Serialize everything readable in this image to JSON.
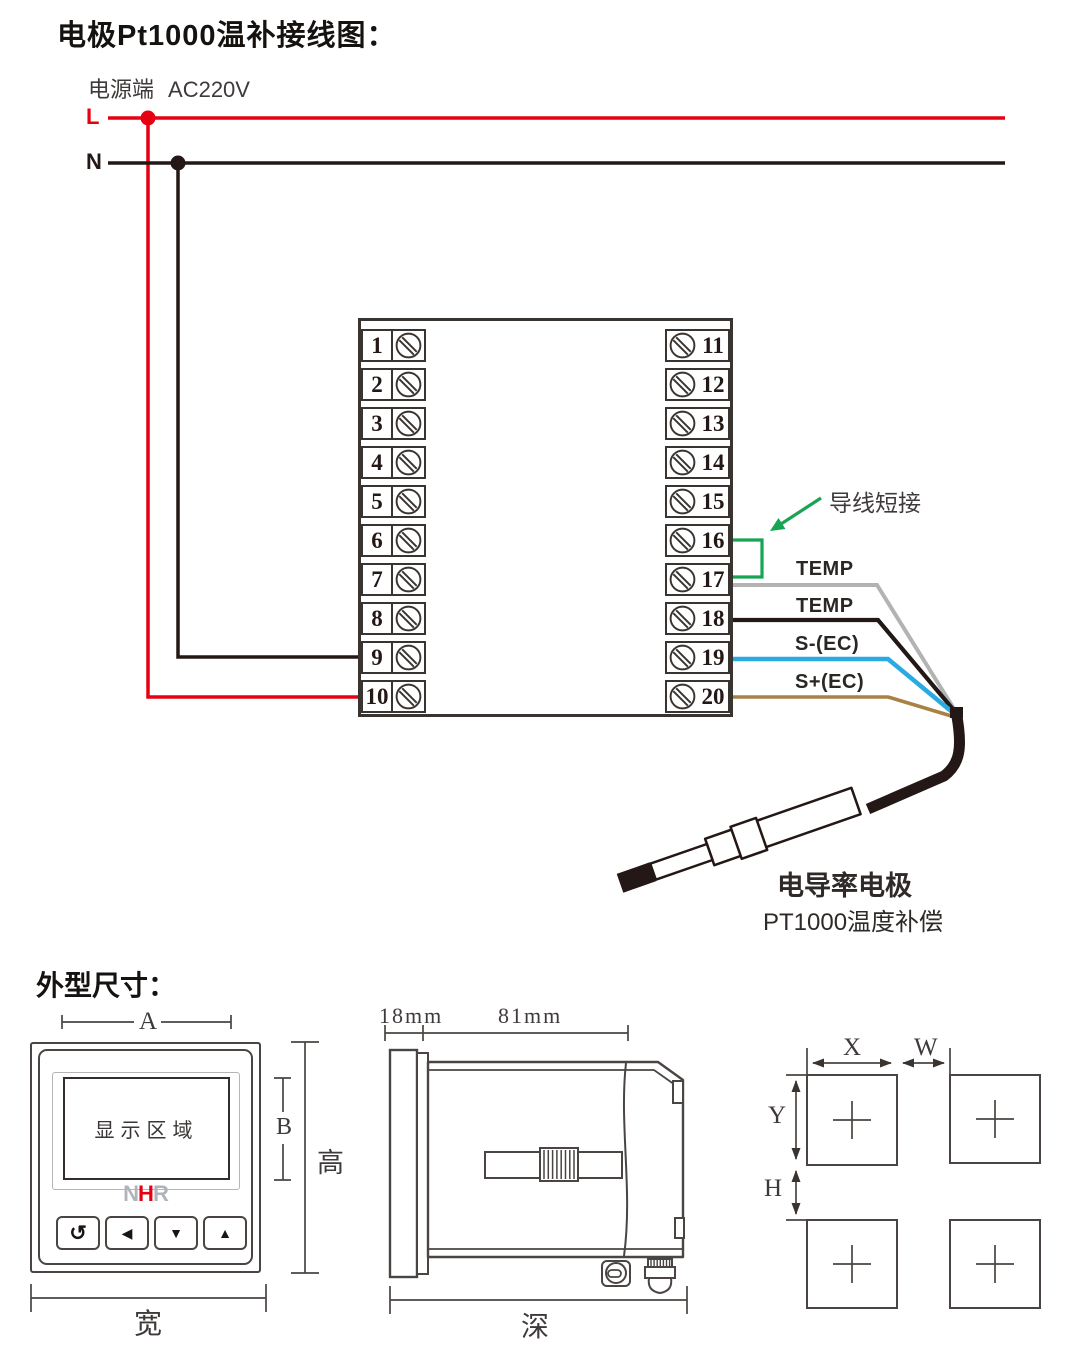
{
  "colors": {
    "red": "#e60012",
    "dark": "#231815",
    "outline": "#3a3430",
    "drawing": "#4a4542",
    "light_gray": "#b5b5b5",
    "green": "#17a554",
    "logo_gray": "#b0b4b9",
    "logo_red": "#e60012"
  },
  "wiring": {
    "title": "电极Pt1000温补接线图：",
    "power": {
      "label": "电源端",
      "voltage": "AC220V"
    },
    "live_label": "L",
    "neutral_label": "N",
    "terminals_left": [
      "1",
      "2",
      "3",
      "4",
      "5",
      "6",
      "7",
      "8",
      "9",
      "10"
    ],
    "terminals_right": [
      "11",
      "12",
      "13",
      "14",
      "15",
      "16",
      "17",
      "18",
      "19",
      "20"
    ],
    "jumper_label": "导线短接",
    "wires": [
      {
        "label": "TEMP",
        "color": "#b3b3b3"
      },
      {
        "label": "TEMP",
        "color": "#231815"
      },
      {
        "label": "S-(EC)",
        "color": "#29abe2"
      },
      {
        "label": "S+(EC)",
        "color": "#aa8145"
      }
    ],
    "probe": {
      "name": "电导率电极",
      "subtitle": "PT1000温度补偿"
    }
  },
  "outline": {
    "title": "外型尺寸：",
    "front": {
      "display_label": "显示区域",
      "logo": {
        "n": "N",
        "h": "H",
        "r": "R"
      },
      "buttons": [
        {
          "name": "loop-button",
          "glyph": "↺"
        },
        {
          "name": "left-button",
          "glyph": "◀"
        },
        {
          "name": "down-button",
          "glyph": "▼"
        },
        {
          "name": "up-button",
          "glyph": "▲"
        }
      ],
      "dims": {
        "a": "A",
        "b": "B",
        "height": "高",
        "width": "宽"
      }
    },
    "side": {
      "dims": {
        "front": "18mm",
        "body": "81mm",
        "depth": "深"
      }
    },
    "cutout": {
      "dims": {
        "x": "X",
        "w": "W",
        "y": "Y",
        "h": "H"
      }
    }
  }
}
